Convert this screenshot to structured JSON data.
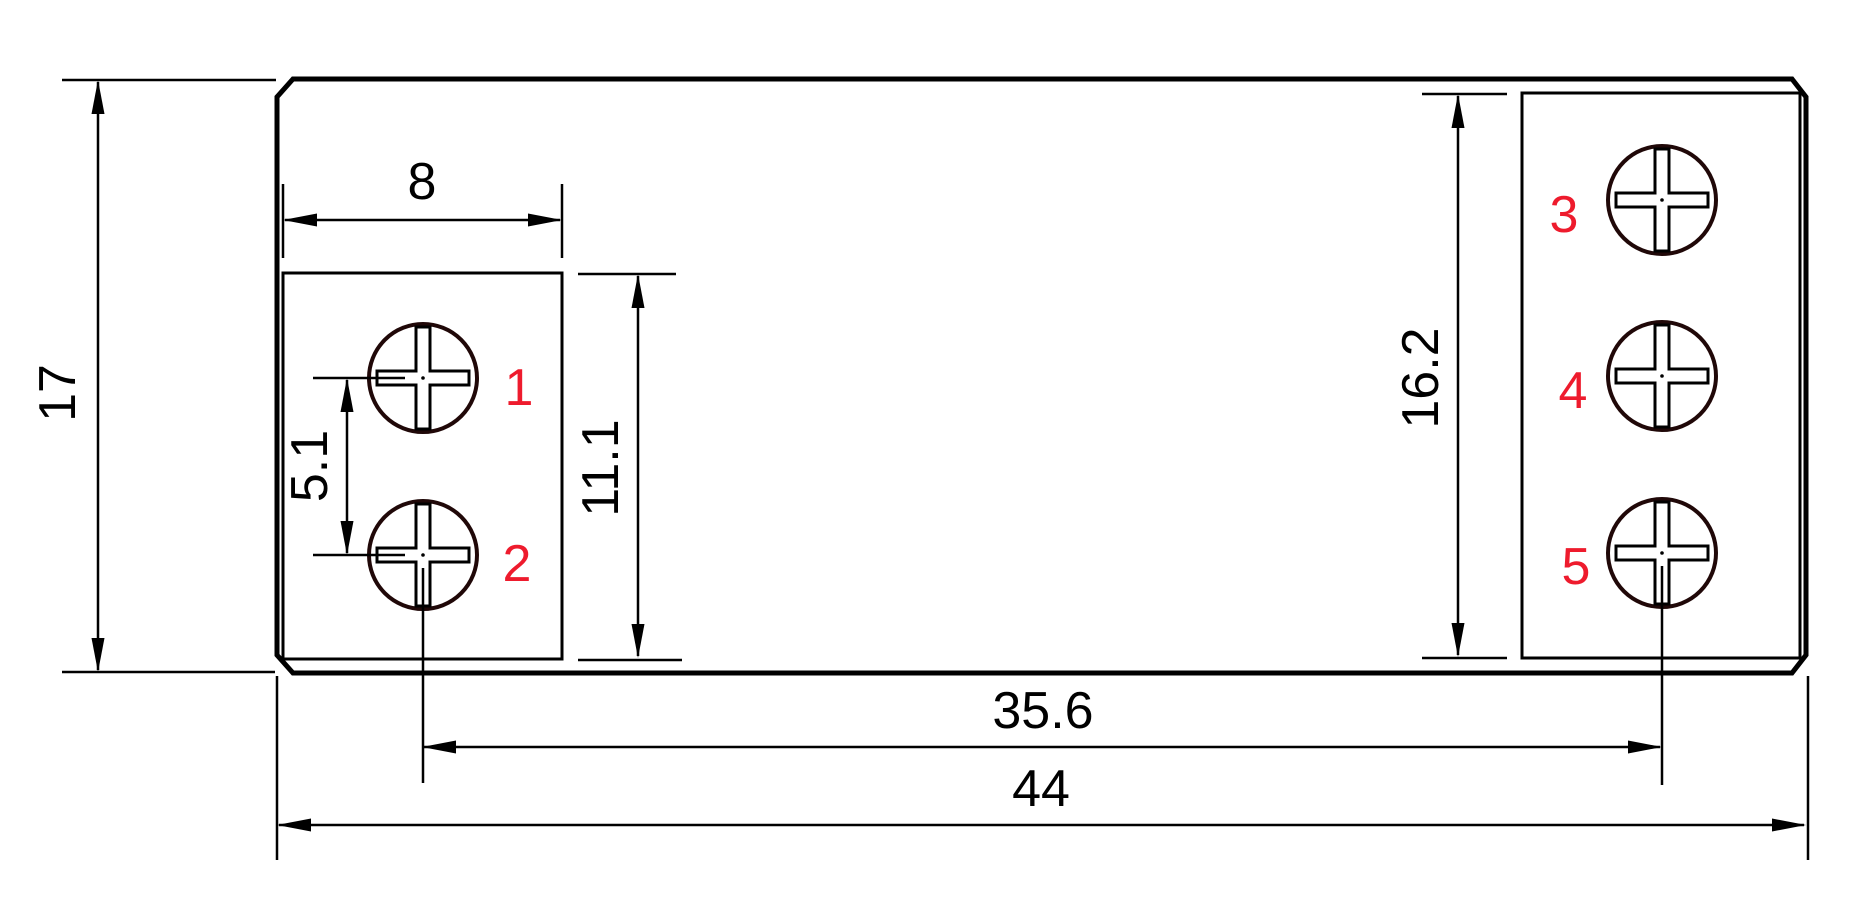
{
  "drawing": {
    "dimensions": {
      "overall_height": "17",
      "left_box_width": "8",
      "left_hole_spacing": "5.1",
      "left_box_height": "11.1",
      "right_box_height": "16.2",
      "hole_span": "35.6",
      "overall_width": "44"
    },
    "terminal_labels": [
      "1",
      "2",
      "3",
      "4",
      "5"
    ],
    "colors": {
      "line": "#000000",
      "label_red": "#ee1b2d",
      "screw_outline": "#200808",
      "background": "#ffffff"
    }
  }
}
